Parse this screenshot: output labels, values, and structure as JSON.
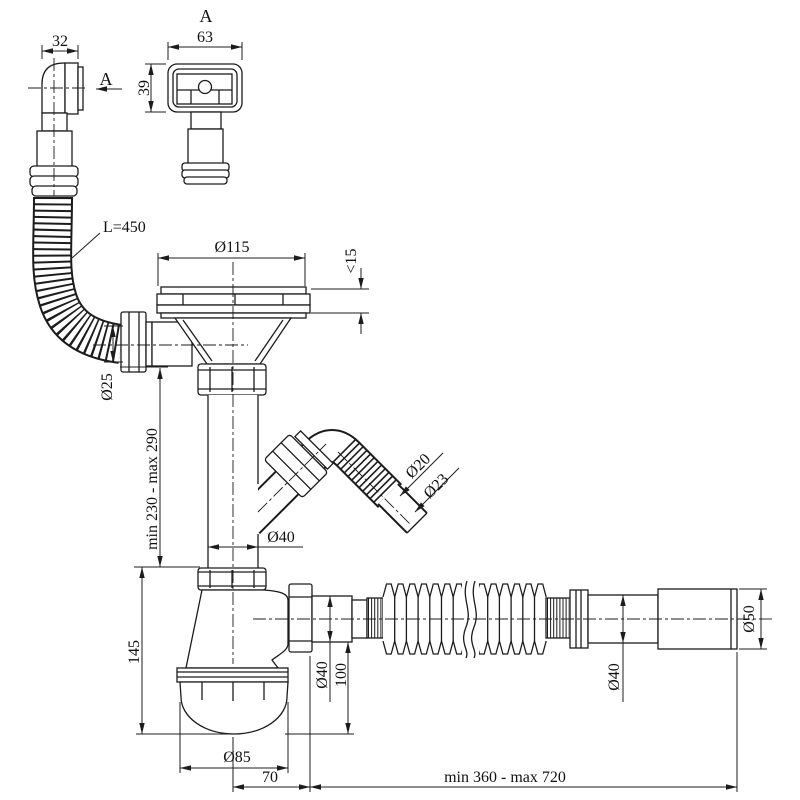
{
  "drawing": {
    "background": "#ffffff",
    "line_color": "#1c1c1c",
    "labels": {
      "view_marker_top": "A",
      "section_arrow": "A",
      "elbow_width": "32",
      "plate_width": "63",
      "plate_height": "39",
      "hose_length": "L=450",
      "flange_diameter": "Ø115",
      "sink_thickness": "<15",
      "overflow_pipe_diameter": "Ø25",
      "height_range": "min 230 - max 290",
      "branch_inner_diameter": "Ø20",
      "branch_outer_diameter": "Ø23",
      "downpipe_diameter": "Ø40",
      "trap_height": "145",
      "outlet_diameter": "Ø40",
      "outlet_drop": "100",
      "cup_diameter": "Ø85",
      "outlet_offset": "70",
      "flex_length_range": "min 360 - max 720",
      "end_pipe_diameter": "Ø40",
      "end_fitting_diameter": "Ø50"
    }
  }
}
